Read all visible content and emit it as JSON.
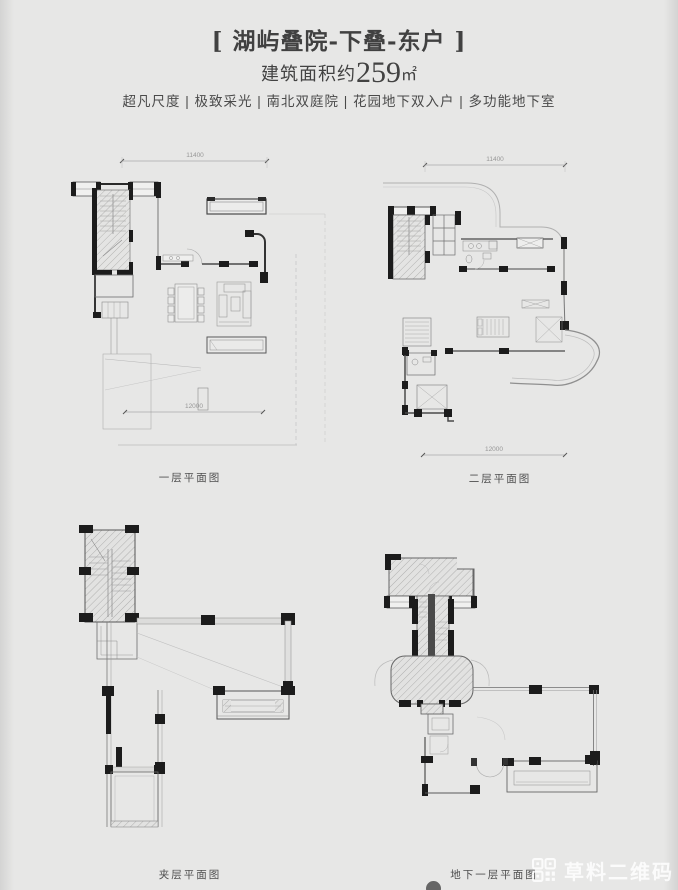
{
  "header": {
    "title": "[ 湖屿叠院-下叠-东户 ]",
    "area_prefix": "建筑面积约",
    "area_number": "259",
    "area_unit": "㎡",
    "tagline": "超凡尺度 | 极致采光 | 南北双庭院 | 花园地下双入户 | 多功能地下室"
  },
  "plans": {
    "floor1": {
      "caption": "一层平面图",
      "dim_top": "11400",
      "dim_bottom": "12000"
    },
    "floor2": {
      "caption": "二层平面图",
      "dim_top": "11400",
      "dim_bottom": "12000"
    },
    "mezzanine": {
      "caption": "夹层平面图"
    },
    "basement": {
      "caption": "地下一层平面图"
    }
  },
  "watermark": {
    "label": "草料二维码"
  },
  "colors": {
    "background": "#e7e7e6",
    "ink": "#3d3d3d",
    "wall_black": "#1c1c1c",
    "line_gray": "#7a7a7a",
    "light_gray": "#c0c0c0",
    "watermark_white": "#ffffff"
  }
}
